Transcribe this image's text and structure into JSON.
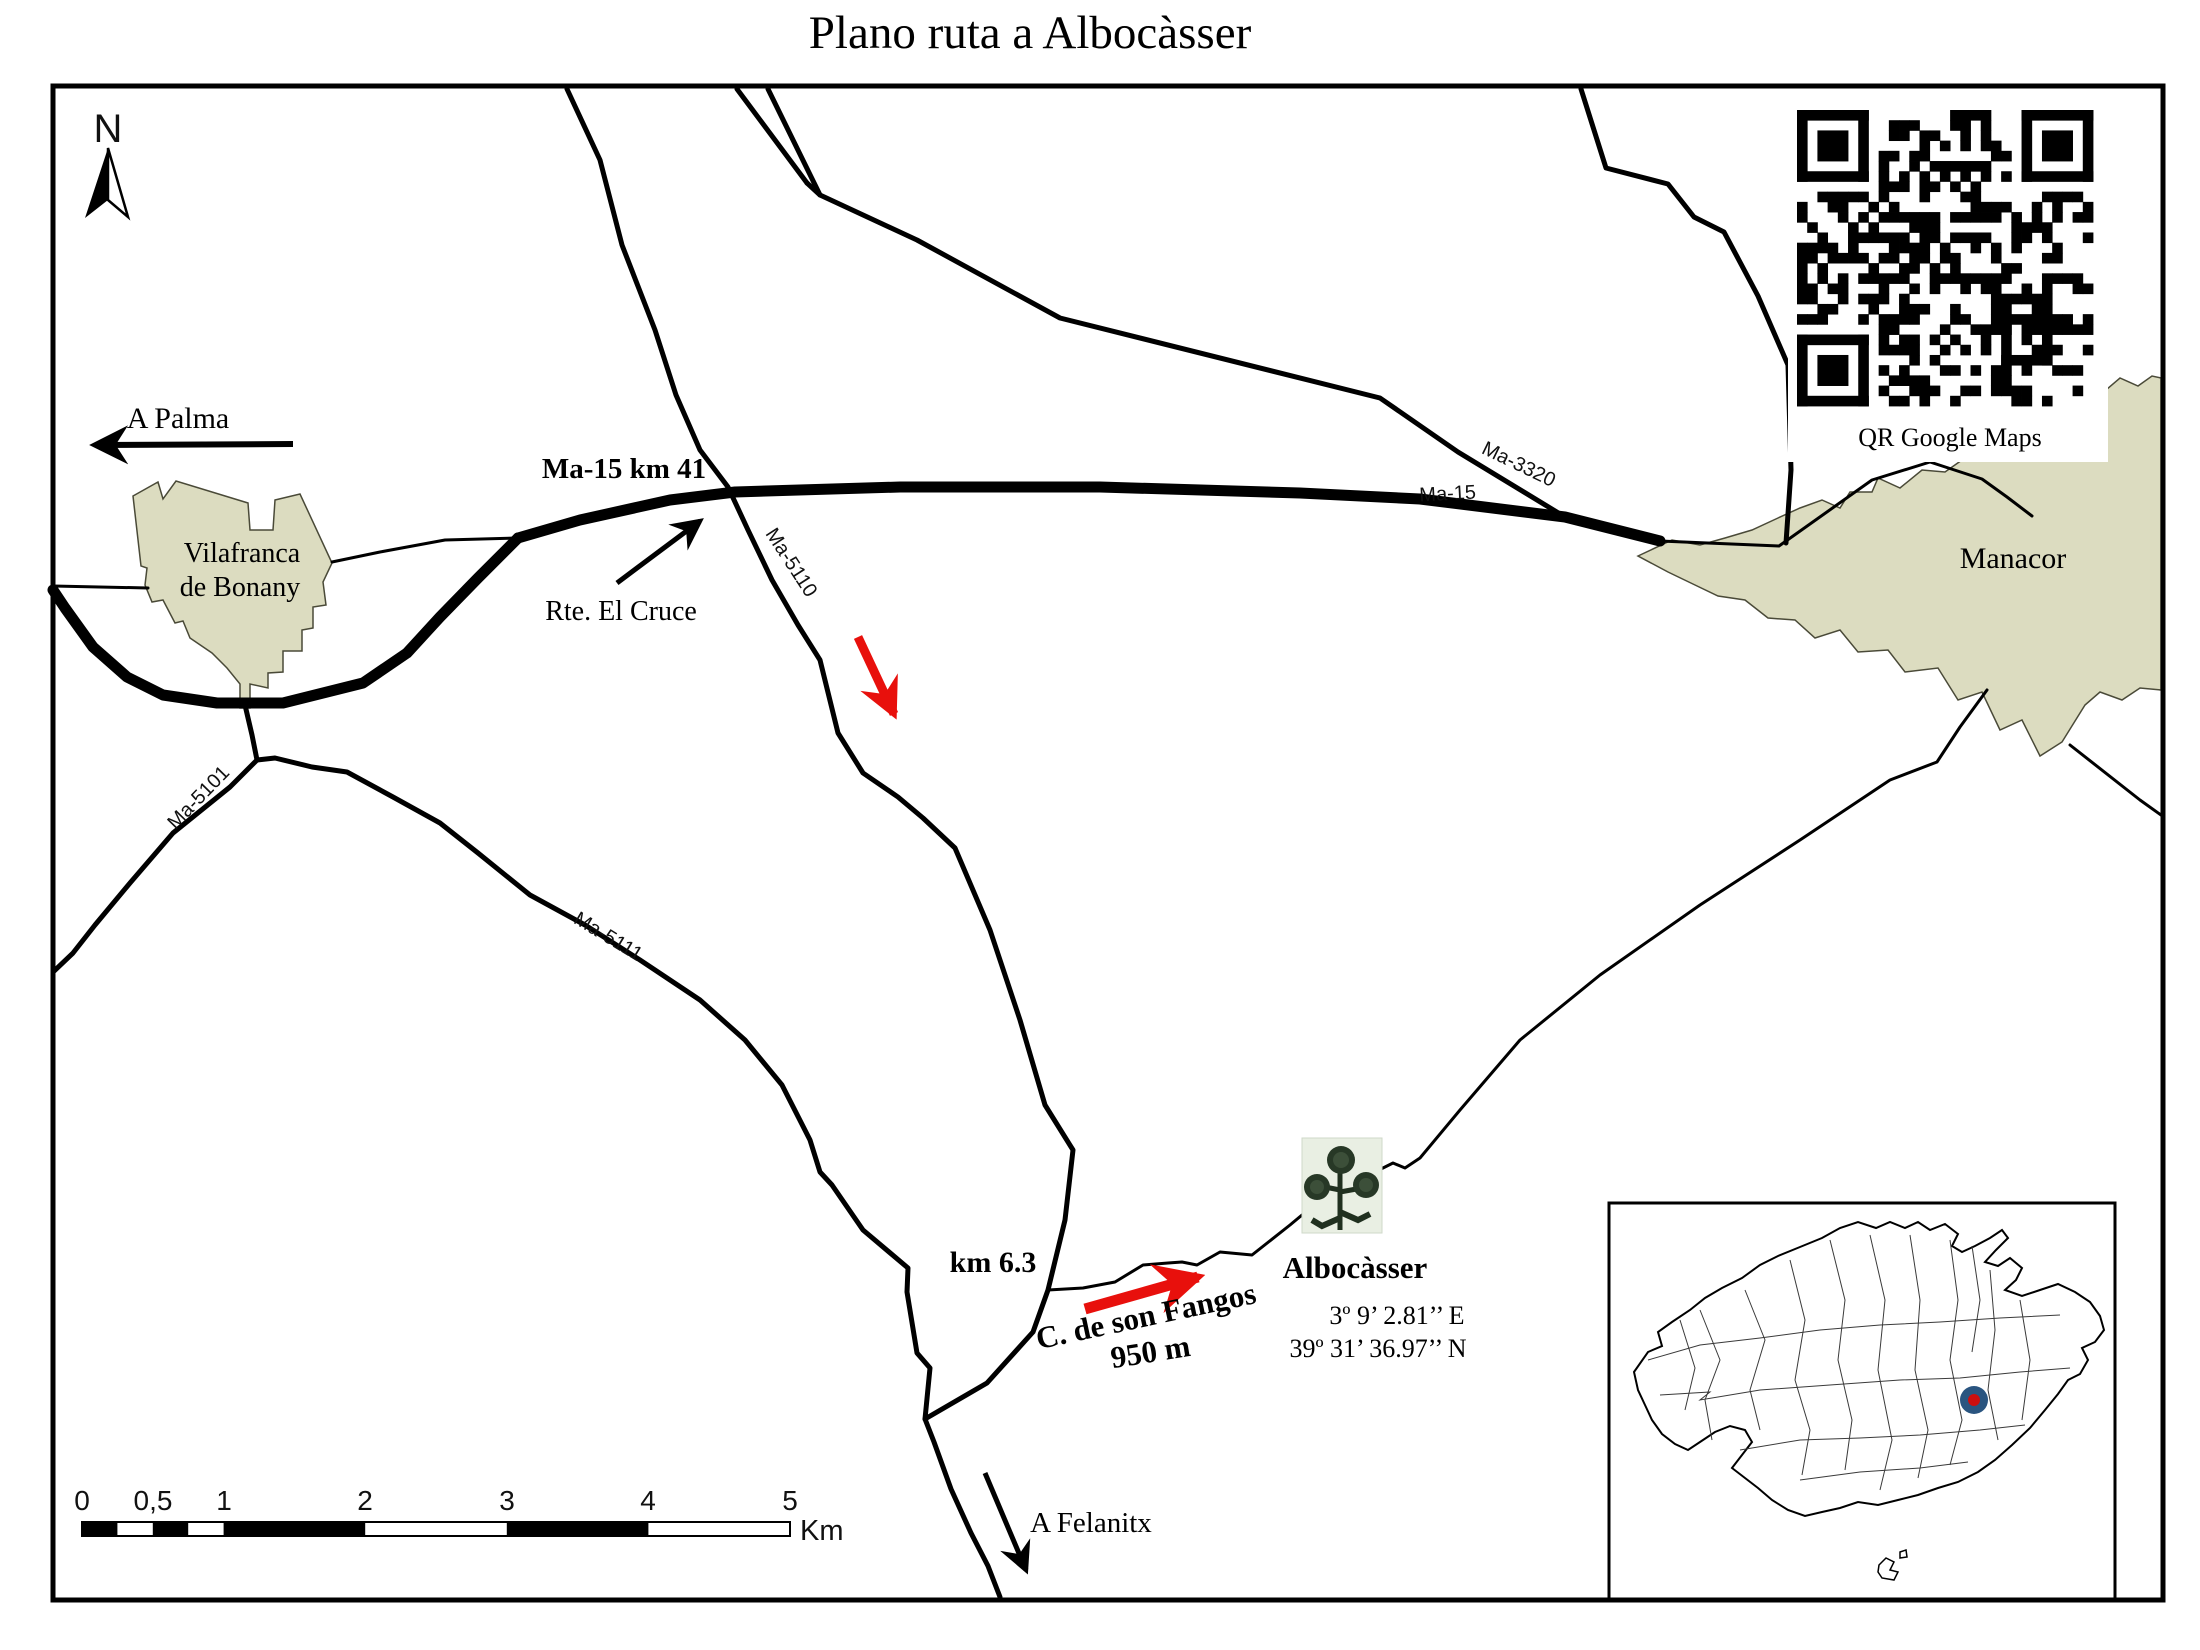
{
  "title": "Plano ruta a Albocàsser",
  "colors": {
    "town_fill": "#dcdcc0",
    "route_red": "#e8100c",
    "marker_blue": "#2a5580",
    "marker_red": "#cc0f0f"
  },
  "compass": {
    "north": "N"
  },
  "directions": {
    "palma": "A Palma",
    "felanitx": "A Felanitx"
  },
  "towns": {
    "vilafranca_line1": "Vilafranca",
    "vilafranca_line2": "de Bonany",
    "manacor": "Manacor"
  },
  "road_labels": {
    "ma15": "Ma-15",
    "ma3320": "Ma-3320",
    "ma5110": "Ma-5110",
    "ma5101": "Ma-5101",
    "ma5111": "Ma-5111"
  },
  "annotations": {
    "ma15_km41": "Ma-15 km 41",
    "rte_el_cruce": "Rte. El Cruce",
    "km63": "km 6.3",
    "fangos": "C. de son Fangos",
    "fangos_dist": "950 m"
  },
  "destination": {
    "name": "Albocàsser",
    "coord_e": "3º 9’ 2.81’’ E",
    "coord_n": "39º 31’ 36.97’’ N"
  },
  "qr": {
    "caption": "QR Google Maps"
  },
  "scalebar": {
    "ticks": [
      "0",
      "0,5",
      "1",
      "2",
      "3",
      "4",
      "5"
    ],
    "unit": "Km"
  }
}
